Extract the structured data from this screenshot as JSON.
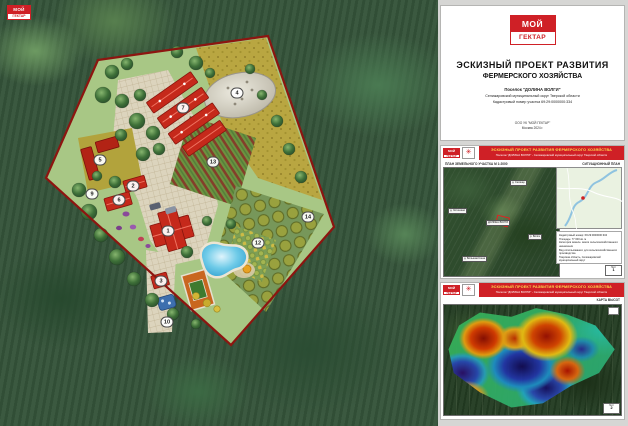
{
  "brand": {
    "logo_top": "МОЙ",
    "logo_bottom": "ГЕКТАР",
    "accent": "#cf2026",
    "emblem_icon": "✳"
  },
  "title_sheet": {
    "title_line1": "ЭСКИЗНЫЙ ПРОЕКТ РАЗВИТИЯ",
    "title_line2": "ФЕРМЕРСКОГО ХОЗЯЙСТВА",
    "subtitle_lines": [
      "Поселок \"ДОЛИНА ВОЛГИ\"",
      "Селижаровский муниципальный округ Тверской области",
      "Кадастровый номер участка 69:29:0000000:334"
    ],
    "footer_lines": [
      "ООО УК \"МОЙ ГЕКТАР\"",
      "Москва 2024 г."
    ]
  },
  "master_plan": {
    "boundary_color": "#8d1510",
    "markers": [
      "1",
      "2",
      "3",
      "4",
      "5",
      "6",
      "7",
      "9",
      "10",
      "12",
      "13",
      "14"
    ]
  },
  "sheet_plan": {
    "header_title": "ЭСКИЗНЫЙ ПРОЕКТ РАЗВИТИЯ ФЕРМЕРСКОГО ХОЗЯЙСТВА",
    "header_subtitle": "Поселок \"ДОЛИНА ВОЛГИ\" - Селижаровский муниципальный округ Тверской области",
    "strip_left": "ПЛАН ЗЕМЕЛЬНОГО УЧАСТКА М 1:2000",
    "strip_right": "СИТУАЦИОННЫЙ ПЛАН",
    "map_labels": [
      "д. Хотошино",
      "д. Селище",
      "ДОЛИНА ВОЛГИ",
      "р. Волга",
      "д. Большая Коша"
    ],
    "info_lines": [
      "Кадастровый номер: 69:29:0000000:334",
      "Площадь: 77 000 кв. м",
      "Категория земель: земли сельскохозяйственного назначения",
      "Вид использования: для сельскохозяйственного производства",
      "Тверская область, Селижаровский муниципальный округ"
    ],
    "sheet_word": "Лист",
    "sheet_number": "1"
  },
  "sheet_heights": {
    "header_title": "ЭСКИЗНЫЙ ПРОЕКТ РАЗВИТИЯ ФЕРМЕРСКОГО ХОЗЯЙСТВА",
    "header_subtitle": "Поселок \"ДОЛИНА ВОЛГИ\" - Селижаровский муниципальный округ Тверской области",
    "caption": "КАРТА ВЫСОТ",
    "sheet_word": "Лист",
    "sheet_number": "2"
  }
}
